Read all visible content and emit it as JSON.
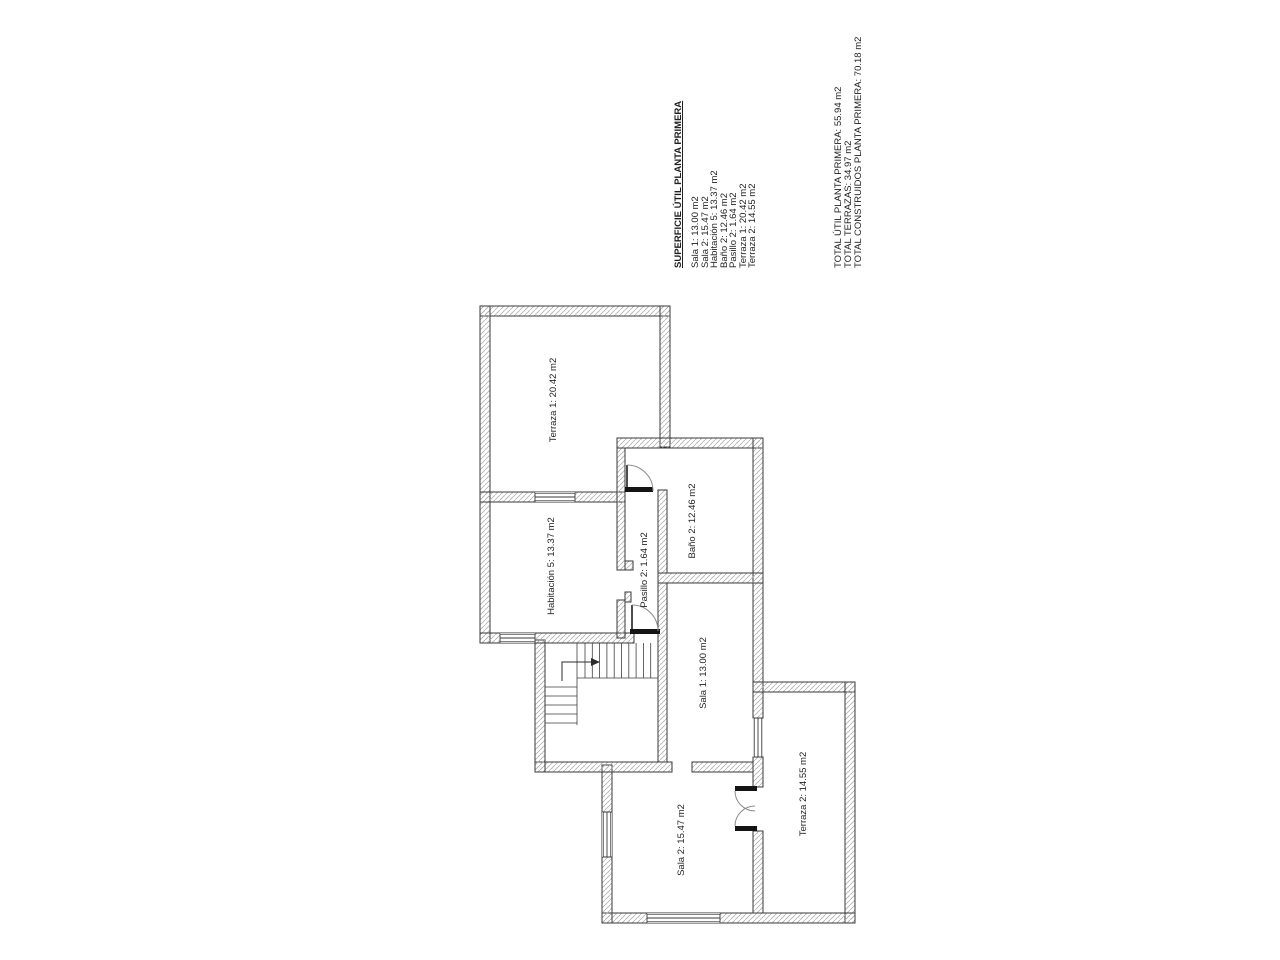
{
  "summary": {
    "title": "SUPERFICIE ÚTIL PLANTA PRIMERA",
    "items": [
      "Sala 1: 13.00 m2",
      "Sala 2: 15.47 m2",
      "Habitación 5: 13.37 m2",
      "Baño 2: 12.46 m2",
      "Pasillo 2: 1.64 m2",
      "Terraza 1: 20.42 m2",
      "Terraza 2: 14.55 m2"
    ],
    "totals": [
      "TOTAL ÚTIL PLANTA PRIMERA: 55.94 m2",
      "TOTAL TERRAZAS: 34.97 m2",
      "TOTAL CONSTRUIDOS PLANTA PRIMERA: 70.18 m2"
    ]
  },
  "plan": {
    "labels": {
      "terraza1": "Terraza 1: 20.42 m2",
      "habitacion5": "Habitación 5: 13.37 m2",
      "bano2": "Baño 2: 12.46 m2",
      "pasillo2": "Pasillo 2: 1.64 m2",
      "sala1": "Sala 1: 13.00 m2",
      "sala2": "Sala 2: 15.47 m2",
      "terraza2": "Terraza 2: 14.55 m2"
    },
    "colors": {
      "ink": "#2f2f2f",
      "wall_outline": "#3a3a3a",
      "wall_hatch": "#b2b2b2",
      "door_threshold": "#141414",
      "background": "#ffffff"
    }
  }
}
